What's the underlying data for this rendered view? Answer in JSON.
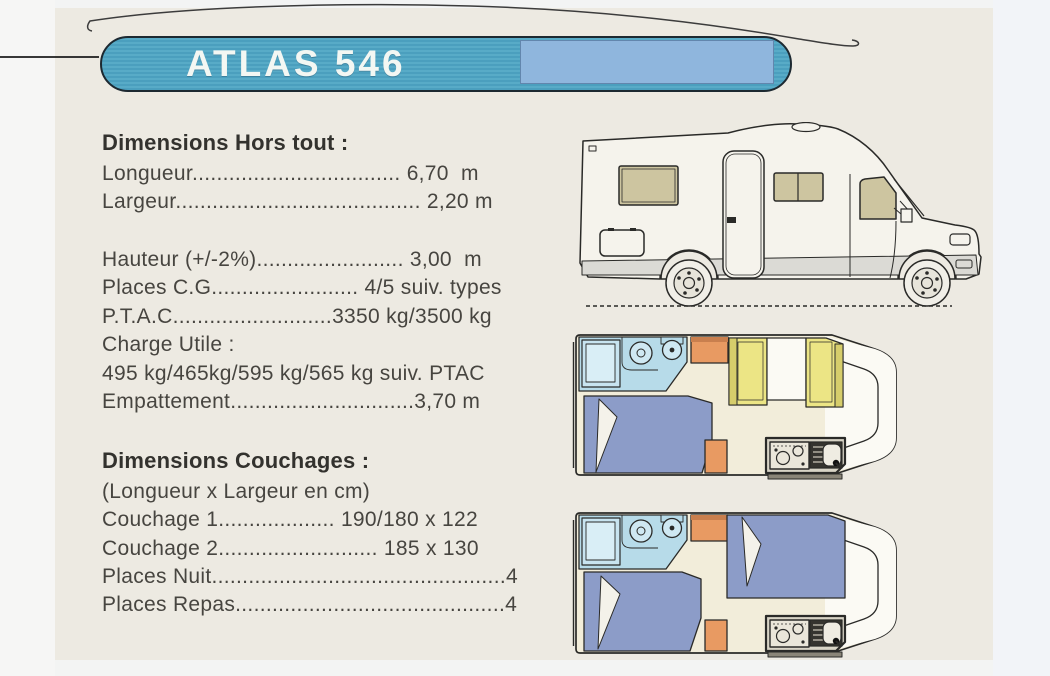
{
  "title_banner": {
    "label": "ATLAS 546"
  },
  "sections": {
    "hors_tout": {
      "heading": "Dimensions Hors tout :",
      "group1": [
        "Longueur.................................. 6,70  m",
        "Largeur........................................ 2,20 m"
      ],
      "group2": [
        "Hauteur (+/-2%)........................ 3,00  m",
        "Places C.G........................ 4/5 suiv. types",
        "P.T.A.C..........................3350 kg/3500 kg",
        "Charge Utile :",
        "495 kg/465kg/595 kg/565 kg suiv. PTAC",
        "Empattement..............................3,70 m"
      ]
    },
    "couchages": {
      "heading": "Dimensions Couchages :",
      "lines": [
        "(Longueur x Largeur en cm)",
        "Couchage 1................... 190/180 x 122",
        "Couchage 2.......................... 185 x 130",
        "Places Nuit................................................4",
        "Places Repas............................................4"
      ]
    }
  },
  "figures": {
    "side_view": "motorhome-side-profile-drawing",
    "floorplan_day": "floorplan-with-dinette",
    "floorplan_night": "floorplan-with-beds"
  },
  "colors": {
    "page_bg": "#edeae2",
    "banner_teal": "#53a6c2",
    "banner_light_blue": "#8fb6dd",
    "banner_text": "#f3f7f3",
    "body_text": "#474540",
    "window_beige": "#cdc5a0",
    "plan_floor_cream": "#f2edda",
    "plan_bath_blue": "#b7dbe9",
    "plan_bed_blue": "#8c9cc8",
    "plan_seat_yellow": "#ece585",
    "plan_cabinet_orange": "#e89a62"
  }
}
